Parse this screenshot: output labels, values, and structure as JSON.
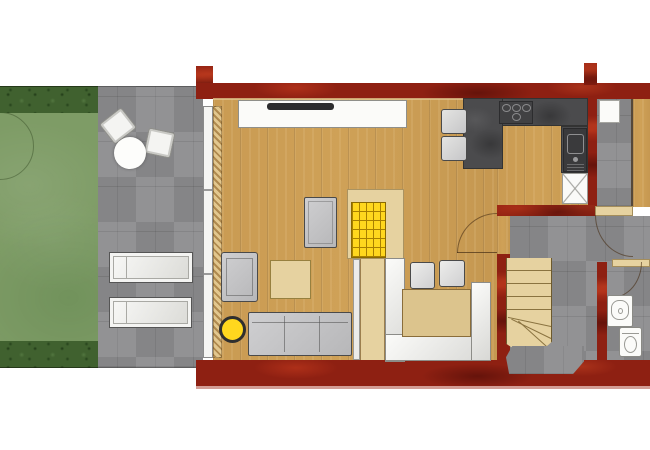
{
  "scene": {
    "kind": "floor-plan",
    "view": "top-down",
    "visible_text": "none"
  },
  "palette": {
    "background": "#ffffff",
    "wall_red": "#8e2012",
    "wall_shadow": "#c8847a",
    "wood": "#cfa157",
    "wood_light": "#e6d2a0",
    "table_wood": "#dcc48d",
    "tile": "#8c8c8e",
    "counter": "#4b4b4d",
    "white_furniture": "#f4f4f2",
    "gray_furniture": "#b7b7b9",
    "yellow": "#ffd71e",
    "lawn": "#7e9c66",
    "hedge": "#40612f",
    "outline": "#4a4a4a"
  },
  "areas": [
    {
      "name": "garden",
      "surface": "lawn"
    },
    {
      "name": "patio",
      "surface": "stone-tiles"
    },
    {
      "name": "living-room",
      "surface": "wood"
    },
    {
      "name": "kitchen",
      "surface": "wood"
    },
    {
      "name": "hallway",
      "surface": "stone-tiles"
    },
    {
      "name": "bathroom",
      "surface": "stone-tiles"
    },
    {
      "name": "side-room",
      "surface": "wood"
    }
  ],
  "furniture": [
    "patio-chair",
    "patio-chair",
    "patio-round-table",
    "sun-lounger",
    "sun-lounger",
    "sideboard",
    "tv",
    "side-table",
    "armchair",
    "coffee-table",
    "yellow-stool",
    "sofa",
    "yellow-grid-stair",
    "dining-table",
    "dining-chair",
    "dining-chair",
    "corner-bench",
    "kitchen-counter",
    "cooktop",
    "sink",
    "dishwasher",
    "bar-stool",
    "bar-stool",
    "appliance",
    "staircase",
    "bath-sink",
    "toilet"
  ]
}
